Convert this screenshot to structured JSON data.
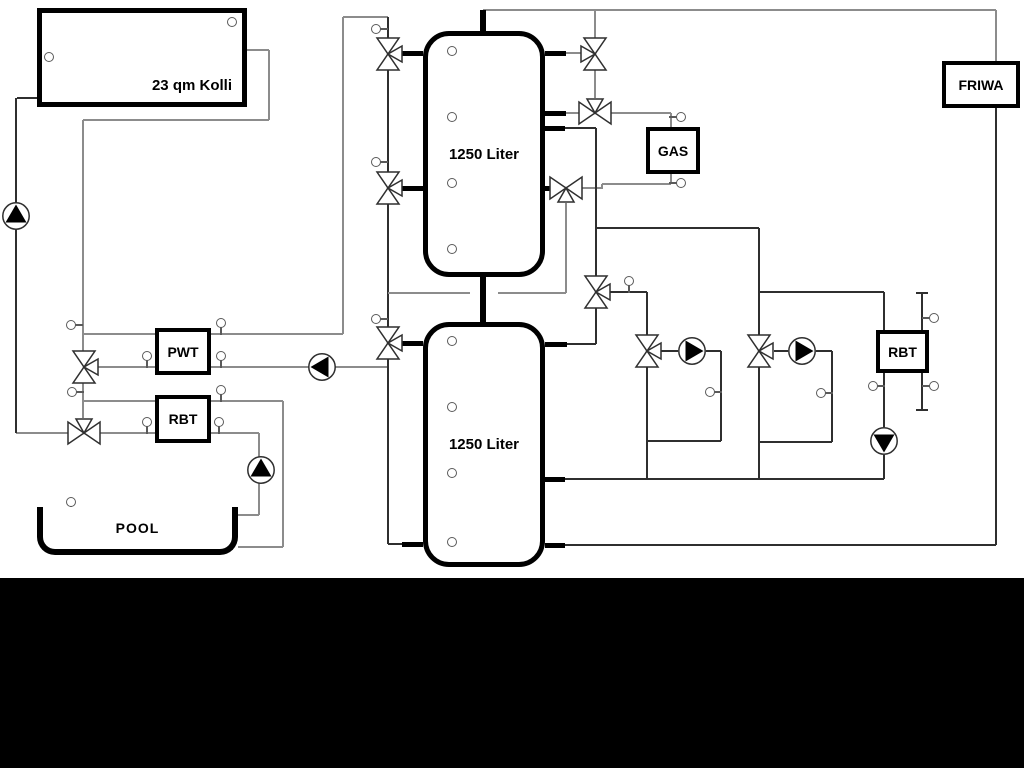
{
  "components": {
    "collector": {
      "label": "23 qm Kolli"
    },
    "buffer_tank_top": {
      "label": "1250 Liter"
    },
    "buffer_tank_bottom": {
      "label": "1250 Liter"
    },
    "pwt": {
      "label": "PWT"
    },
    "rbt_pool": {
      "label": "RBT"
    },
    "gas_boiler": {
      "label": "GAS"
    },
    "rbt_right": {
      "label": "RBT"
    },
    "friwa": {
      "label": "FRIWA"
    },
    "pool": {
      "label": "POOL"
    }
  },
  "colors": {
    "pipe_gray": "#8c8c8c",
    "pipe_dark": "#2f2f2f",
    "component_outline": "#000000",
    "background": "#ffffff",
    "bottom_bar": "#000000"
  }
}
